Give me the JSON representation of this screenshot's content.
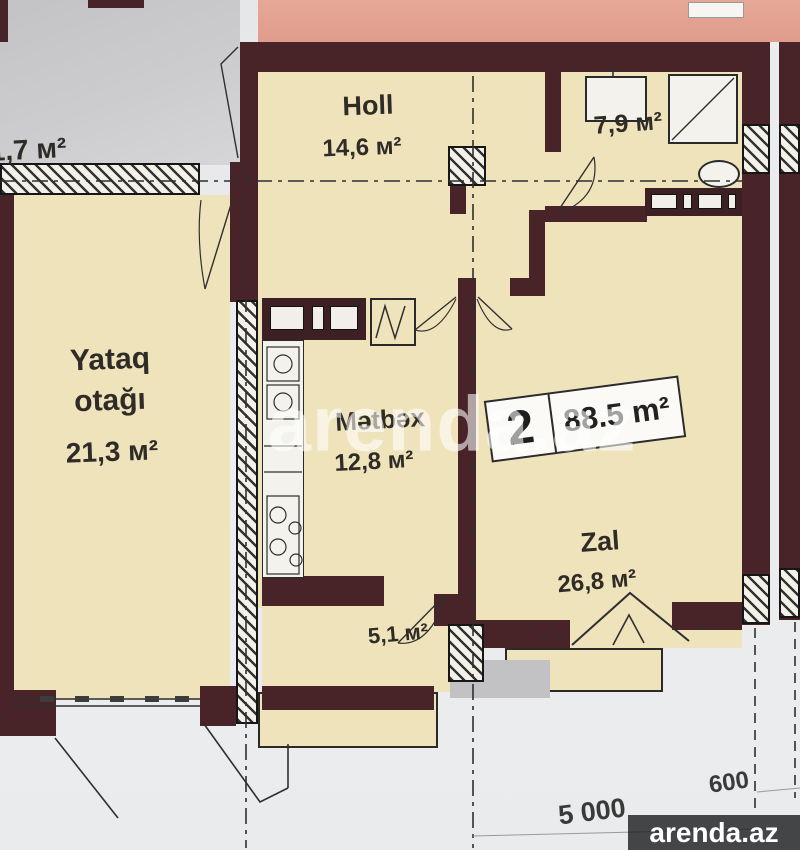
{
  "unit": {
    "type_number": "2",
    "total_area": "88.5 m²"
  },
  "rooms": {
    "holl": {
      "name": "Holl",
      "area": "14,6 м²"
    },
    "bathroom": {
      "area": "7,9 м²"
    },
    "bedroom": {
      "name_line1": "Yataq",
      "name_line2": "otağı",
      "area": "21,3 м²"
    },
    "kitchen": {
      "name": "Mətbəx",
      "area": "12,8 м²"
    },
    "living": {
      "name": "Zal",
      "area": "26,8 м²"
    },
    "balcony": {
      "area": "5,1 м²"
    },
    "neighbor": {
      "area": "1,7 м²"
    }
  },
  "dimensions": {
    "bottom_width": "5 000",
    "bottom_side": "600"
  },
  "watermarks": {
    "center": "arenda.az",
    "logo": "arenda.az"
  },
  "colors": {
    "wall": "#482429",
    "room_fill": "#efe3bc",
    "neighbor_pink": "#e2a294",
    "neighbor_gray": "#c8c8ca",
    "paper": "#e9eaec"
  }
}
